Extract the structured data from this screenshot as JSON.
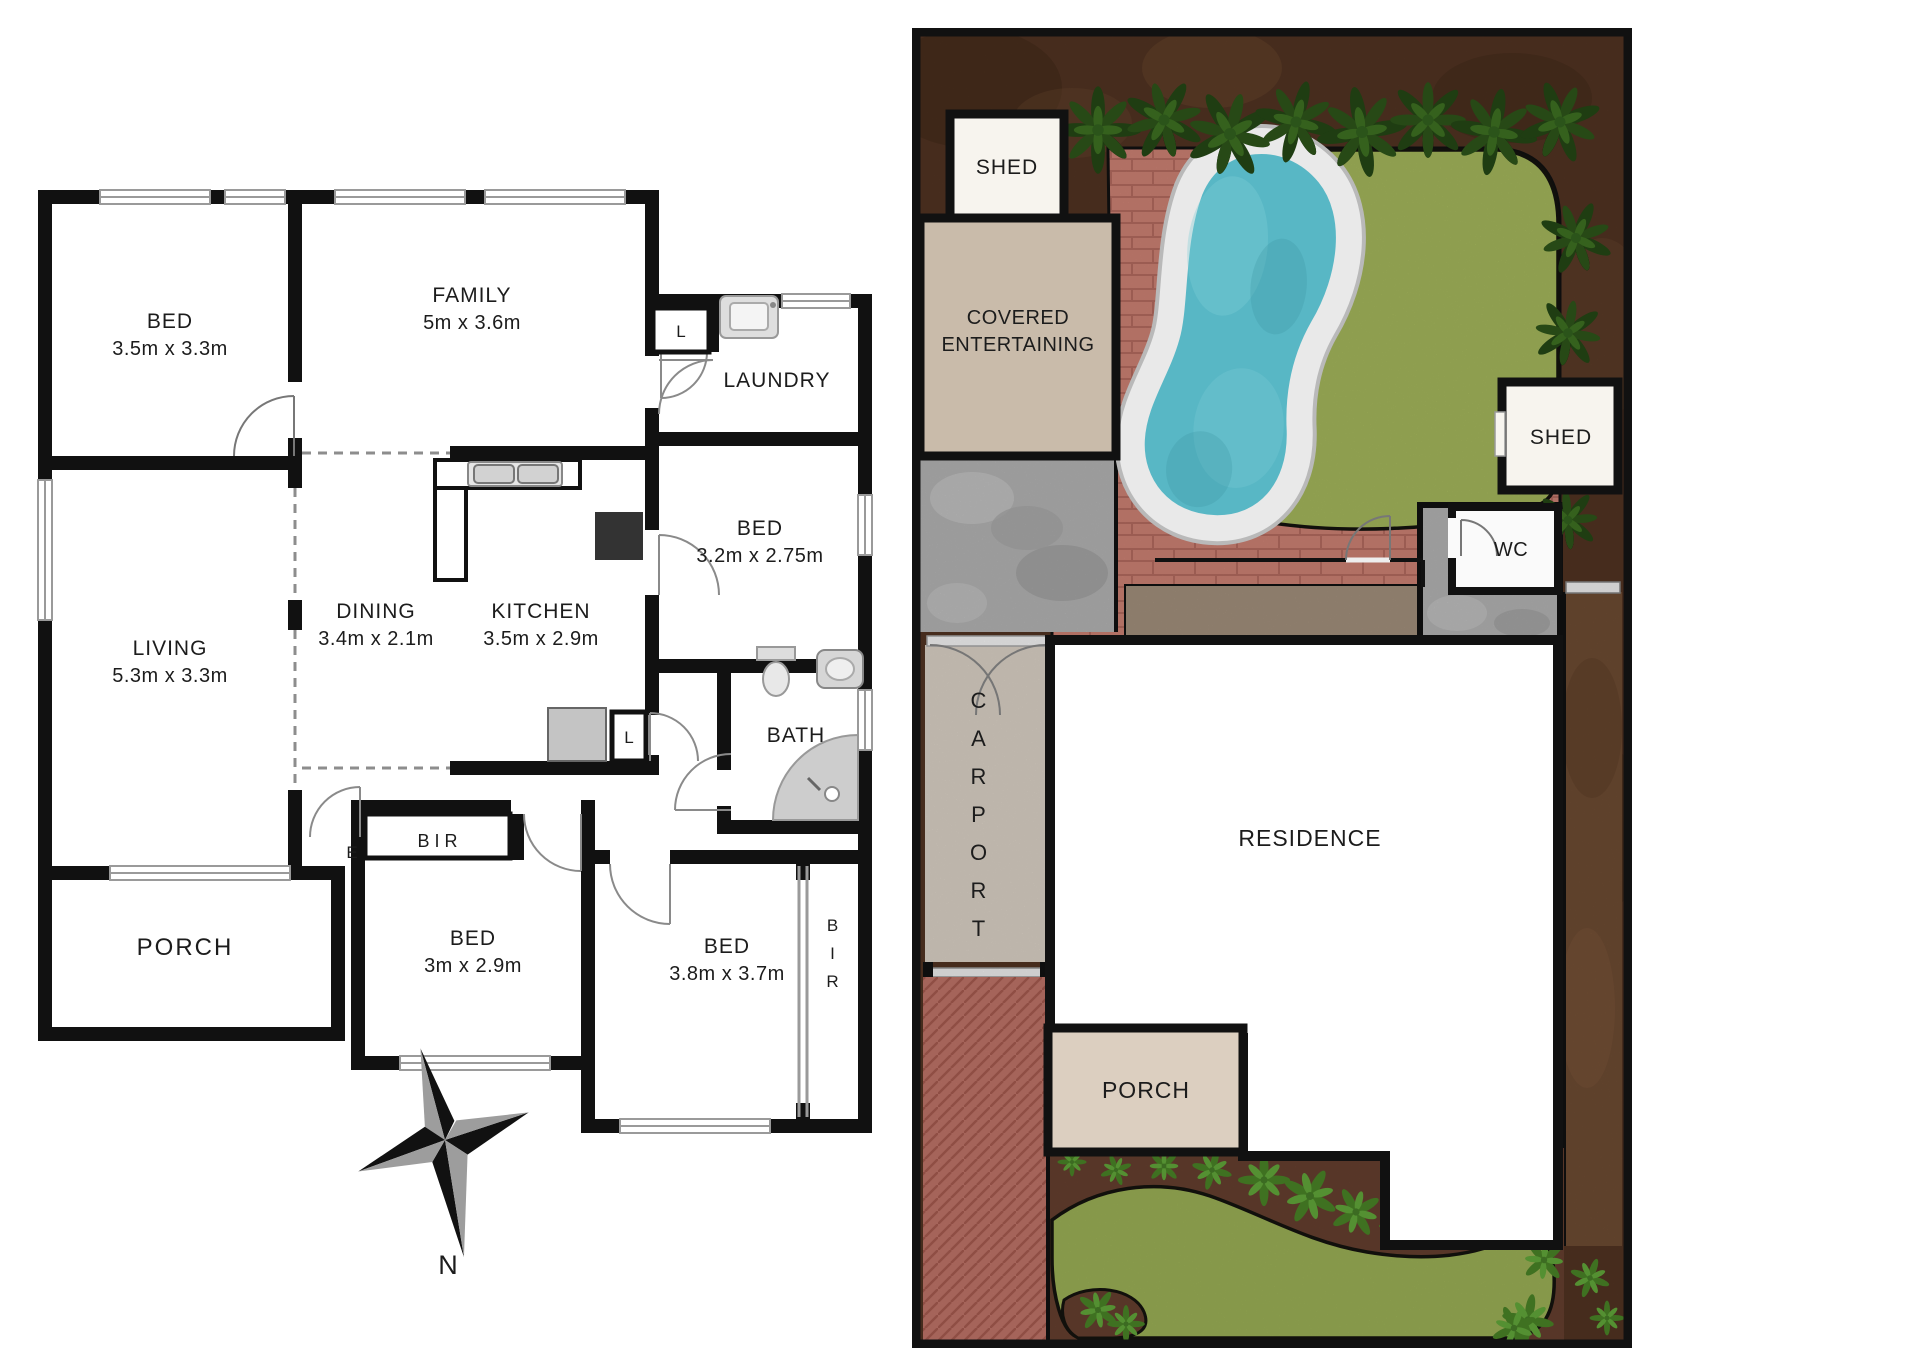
{
  "floor_plan": {
    "rooms": {
      "bed1": {
        "name": "BED",
        "dims": "3.5m x 3.3m"
      },
      "family": {
        "name": "FAMILY",
        "dims": "5m x 3.6m"
      },
      "laundry": {
        "name": "LAUNDRY"
      },
      "bed2": {
        "name": "BED",
        "dims": "3.2m x 2.75m"
      },
      "living": {
        "name": "LIVING",
        "dims": "5.3m x 3.3m"
      },
      "dining": {
        "name": "DINING",
        "dims": "3.4m x 2.1m"
      },
      "kitchen": {
        "name": "KITCHEN",
        "dims": "3.5m x 2.9m"
      },
      "bath": {
        "name": "BATH"
      },
      "porch": {
        "name": "PORCH"
      },
      "bed3": {
        "name": "BED",
        "dims": "3m x 2.9m"
      },
      "bed4": {
        "name": "BED",
        "dims": "3.8m x 3.7m"
      }
    },
    "markers": {
      "linen": "L",
      "entry": "E",
      "bir": "BIR"
    },
    "compass": {
      "north": "N"
    }
  },
  "site_plan": {
    "labels": {
      "shed": "SHED",
      "covered_line1": "COVERED",
      "covered_line2": "ENTERTAINING",
      "wc": "WC",
      "carport": "CARPORT",
      "residence": "RESIDENCE",
      "porch": "PORCH"
    },
    "colors": {
      "soil": "#523423",
      "paving_brick": "#cf8376",
      "lawn": "#a7b95d",
      "pool_water": "#58b7c5",
      "pool_coping": "#e9e9e9",
      "concrete": "#b6b6b6",
      "carport": "#ddd4c8",
      "covered_entertaining": "#c9bbaa",
      "deck": "#a4917e",
      "porch": "#dccfc0",
      "driveway": "#c2756a",
      "plant_green": "#1f3d12",
      "garden_soil": "#66402f",
      "wall_black": "#111111"
    }
  }
}
